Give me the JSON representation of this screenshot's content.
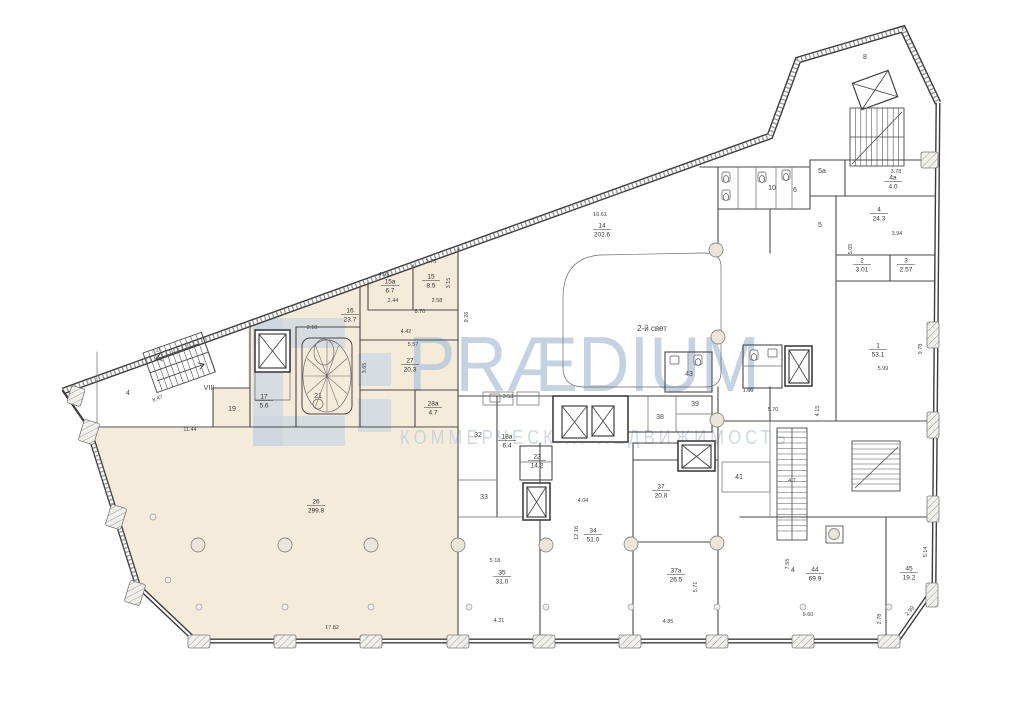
{
  "title": "floor-plan",
  "colors": {
    "highlight": "#f5ebdb",
    "wall": "#3d3d3d",
    "thin_wall": "#6a6a6a",
    "watermark_brand": "#b7c7db",
    "watermark_tagline": "#c3cedd",
    "watermark_logo": "#c2d1e2",
    "column_fill": "#ece6da"
  },
  "watermark": {
    "brand": "PRÆDIUM",
    "tagline": "КОММЕРЧЕСКАЯ НЕДВИЖИМОСТЬ"
  },
  "rooms": [
    {
      "num": "26",
      "area": "299.8",
      "x": 316,
      "y": 505
    },
    {
      "num": "21",
      "x": 318,
      "y": 396
    },
    {
      "num": "16",
      "area": "23.7",
      "x": 350,
      "y": 314
    },
    {
      "num": "15а",
      "area": "6.7",
      "x": 390,
      "y": 285
    },
    {
      "num": "15",
      "area": "8.5",
      "x": 431,
      "y": 280
    },
    {
      "num": "27",
      "area": "20.3",
      "x": 410,
      "y": 364
    },
    {
      "num": "28а",
      "area": "4.7",
      "x": 433,
      "y": 407
    },
    {
      "num": "17",
      "area": "5.6",
      "x": 264,
      "y": 400
    },
    {
      "num": "19",
      "x": 232,
      "y": 409
    },
    {
      "num": "VIII",
      "x": 209,
      "y": 388
    },
    {
      "num": "4",
      "x": 128,
      "y": 393
    },
    {
      "num": "14",
      "area": "202.6",
      "x": 602,
      "y": 229
    },
    {
      "num": "2-й свет",
      "x": 652,
      "y": 329
    },
    {
      "num": "32",
      "x": 478,
      "y": 435
    },
    {
      "num": "18а",
      "area": "6.4",
      "x": 507,
      "y": 440
    },
    {
      "num": "22",
      "area": "14.2",
      "x": 537,
      "y": 460
    },
    {
      "num": "33",
      "x": 484,
      "y": 497
    },
    {
      "num": "35",
      "area": "31.0",
      "x": 502,
      "y": 576
    },
    {
      "num": "34",
      "area": "51.0",
      "x": 593,
      "y": 534
    },
    {
      "num": "37",
      "area": "20.8",
      "x": 661,
      "y": 490
    },
    {
      "num": "37а",
      "area": "26.5",
      "x": 676,
      "y": 574
    },
    {
      "num": "41",
      "x": 739,
      "y": 477
    },
    {
      "num": "4",
      "x": 793,
      "y": 570
    },
    {
      "num": "44",
      "area": "69.9",
      "x": 815,
      "y": 573
    },
    {
      "num": "45",
      "area": "19.2",
      "x": 909,
      "y": 572
    },
    {
      "num": "1",
      "area": "53.1",
      "x": 878,
      "y": 349
    },
    {
      "num": "4",
      "area": "24.3",
      "x": 879,
      "y": 213
    },
    {
      "num": "2",
      "area": "3.01",
      "x": 862,
      "y": 264
    },
    {
      "num": "3",
      "area": "2.57",
      "x": 906,
      "y": 264
    },
    {
      "num": "4а",
      "area": "4.0",
      "x": 893,
      "y": 181
    },
    {
      "num": "38",
      "x": 660,
      "y": 417
    },
    {
      "num": "39",
      "x": 695,
      "y": 404
    },
    {
      "num": "43",
      "x": 689,
      "y": 374
    },
    {
      "num": "8",
      "x": 865,
      "y": 57
    },
    {
      "num": "6",
      "x": 795,
      "y": 190
    },
    {
      "num": "10",
      "x": 772,
      "y": 188
    },
    {
      "num": "5а",
      "x": 822,
      "y": 171
    },
    {
      "num": "5",
      "x": 820,
      "y": 225
    }
  ],
  "dimensions": [
    {
      "t": "11.44",
      "x": 190,
      "y": 431
    },
    {
      "t": "17.82",
      "x": 332,
      "y": 629
    },
    {
      "t": "16.61",
      "x": 600,
      "y": 216
    },
    {
      "t": "2.10",
      "x": 312,
      "y": 329
    },
    {
      "t": "4.42",
      "x": 406,
      "y": 333
    },
    {
      "t": "5.57",
      "x": 413,
      "y": 346
    },
    {
      "t": "3.65",
      "x": 366,
      "y": 368,
      "r": -90
    },
    {
      "t": "8.70",
      "x": 420,
      "y": 313
    },
    {
      "t": "2.44",
      "x": 393,
      "y": 302
    },
    {
      "t": "2.58",
      "x": 437,
      "y": 302
    },
    {
      "t": "4.95",
      "x": 384,
      "y": 276
    },
    {
      "t": "2.75",
      "x": 431,
      "y": 263
    },
    {
      "t": "3.15",
      "x": 450,
      "y": 283,
      "r": -90
    },
    {
      "t": "7.21",
      "x": 157,
      "y": 352,
      "r": -20
    },
    {
      "t": "8.47",
      "x": 158,
      "y": 400,
      "r": -20
    },
    {
      "t": "5.18",
      "x": 495,
      "y": 562
    },
    {
      "t": "4.31",
      "x": 499,
      "y": 622
    },
    {
      "t": "4.04",
      "x": 583,
      "y": 502
    },
    {
      "t": "12.18",
      "x": 578,
      "y": 533,
      "r": -90
    },
    {
      "t": "4.85",
      "x": 668,
      "y": 623
    },
    {
      "t": "5.71",
      "x": 697,
      "y": 587,
      "r": -90
    },
    {
      "t": "9.60",
      "x": 808,
      "y": 616
    },
    {
      "t": "7.55",
      "x": 789,
      "y": 564,
      "r": -90
    },
    {
      "t": "2.78",
      "x": 881,
      "y": 619,
      "r": -90
    },
    {
      "t": "2.99",
      "x": 911,
      "y": 612,
      "r": -48
    },
    {
      "t": "5.14",
      "x": 927,
      "y": 552,
      "r": -90
    },
    {
      "t": "5.70",
      "x": 773,
      "y": 411
    },
    {
      "t": "4.15",
      "x": 819,
      "y": 411,
      "r": -90
    },
    {
      "t": "4.7",
      "x": 792,
      "y": 482
    },
    {
      "t": "5.05",
      "x": 852,
      "y": 249,
      "r": -90
    },
    {
      "t": "3.78",
      "x": 896,
      "y": 173
    },
    {
      "t": "3.94",
      "x": 897,
      "y": 235
    },
    {
      "t": "5.99",
      "x": 883,
      "y": 370
    },
    {
      "t": "9.78",
      "x": 922,
      "y": 349,
      "r": -90
    },
    {
      "t": "9.26",
      "x": 468,
      "y": 317,
      "r": -90
    },
    {
      "t": "3.53",
      "x": 508,
      "y": 398
    },
    {
      "t": "1.66",
      "x": 748,
      "y": 392
    }
  ]
}
